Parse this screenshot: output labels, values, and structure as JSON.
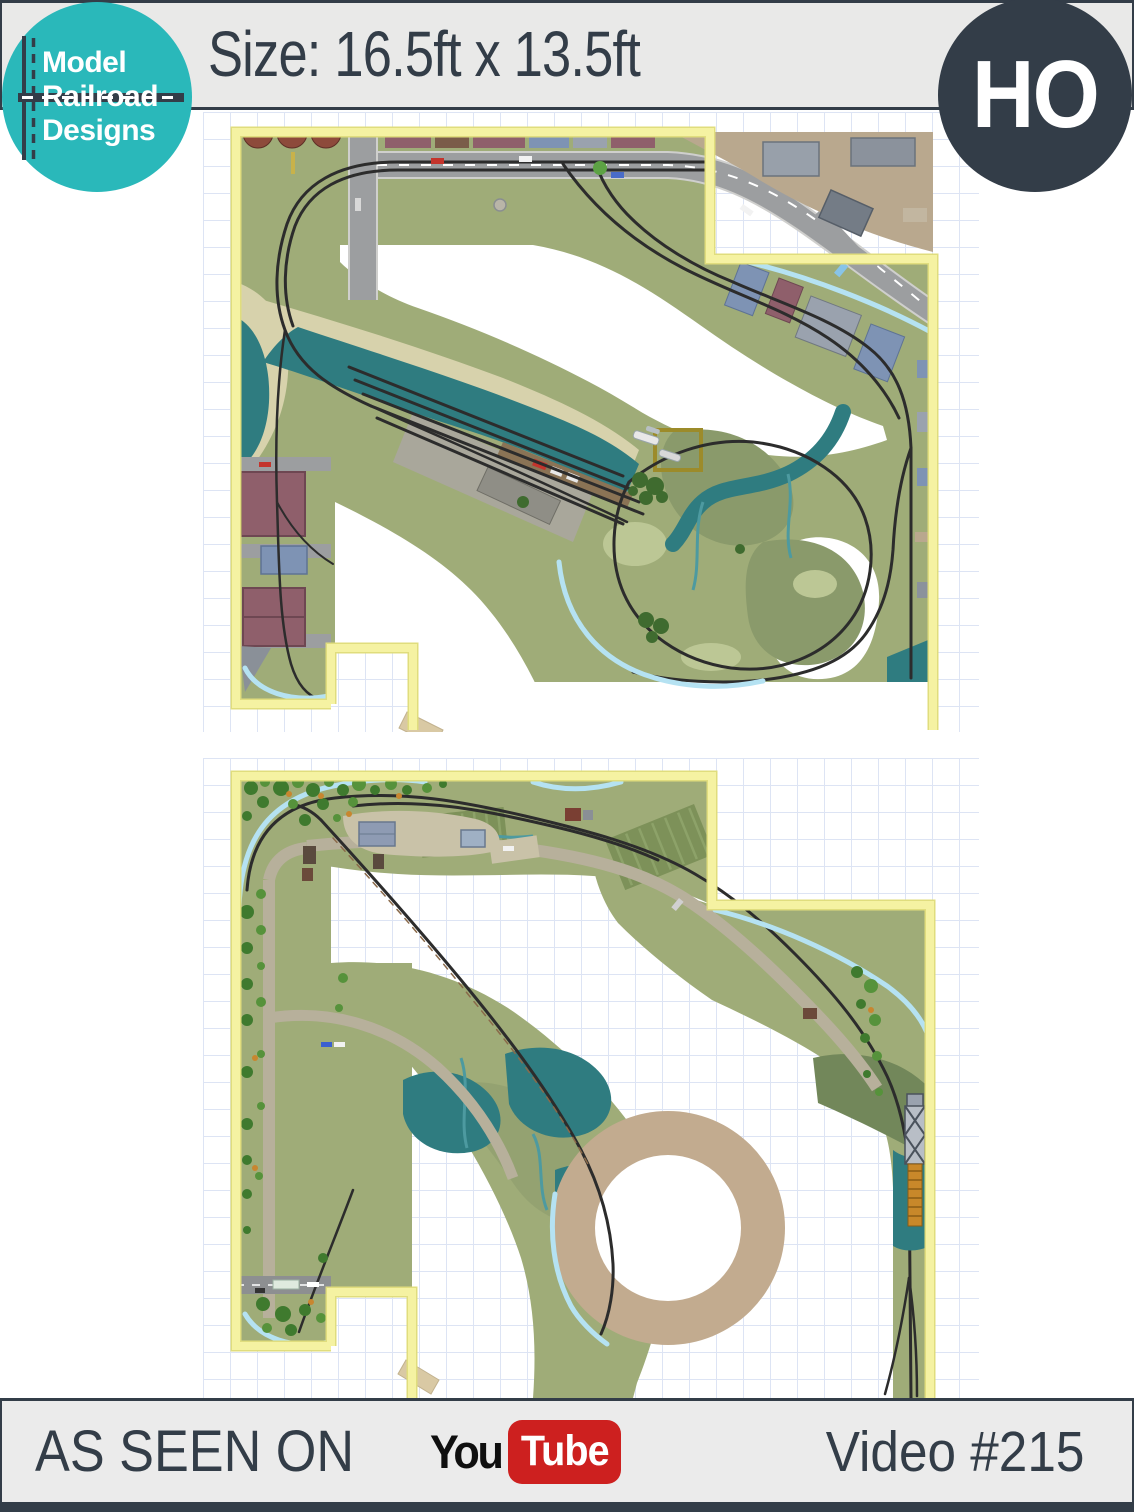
{
  "header": {
    "size_label": "Size: 16.5ft x 13.5ft"
  },
  "logo": {
    "line1": "Model",
    "line2": "Railroad",
    "line3": "Designs"
  },
  "scale_badge": {
    "label": "HO"
  },
  "footer": {
    "as_seen_on": "AS SEEN ON",
    "youtube_you": "You",
    "youtube_tube": "Tube",
    "video_label": "Video #215"
  },
  "colors": {
    "teal": "#2ab8ba",
    "dark": "#333d48",
    "header_bg": "#e9e9e8",
    "footer_bg": "#ebebeb",
    "yt_red": "#cd201f",
    "grid": "#dde4f4",
    "benchwork_yellow": "#f5f2a2",
    "terrain_green": "#9fac78",
    "terrain_dark": "#8a9a6b",
    "water_teal": "#2f7c80",
    "stream_blue": "#b5e2f2",
    "road_gray": "#9c9ea0",
    "track_black": "#2c2c2c",
    "helix_tan": "#c2ab8f",
    "sand": "#d7d2ac",
    "tree_green": "#3f6b2f"
  }
}
